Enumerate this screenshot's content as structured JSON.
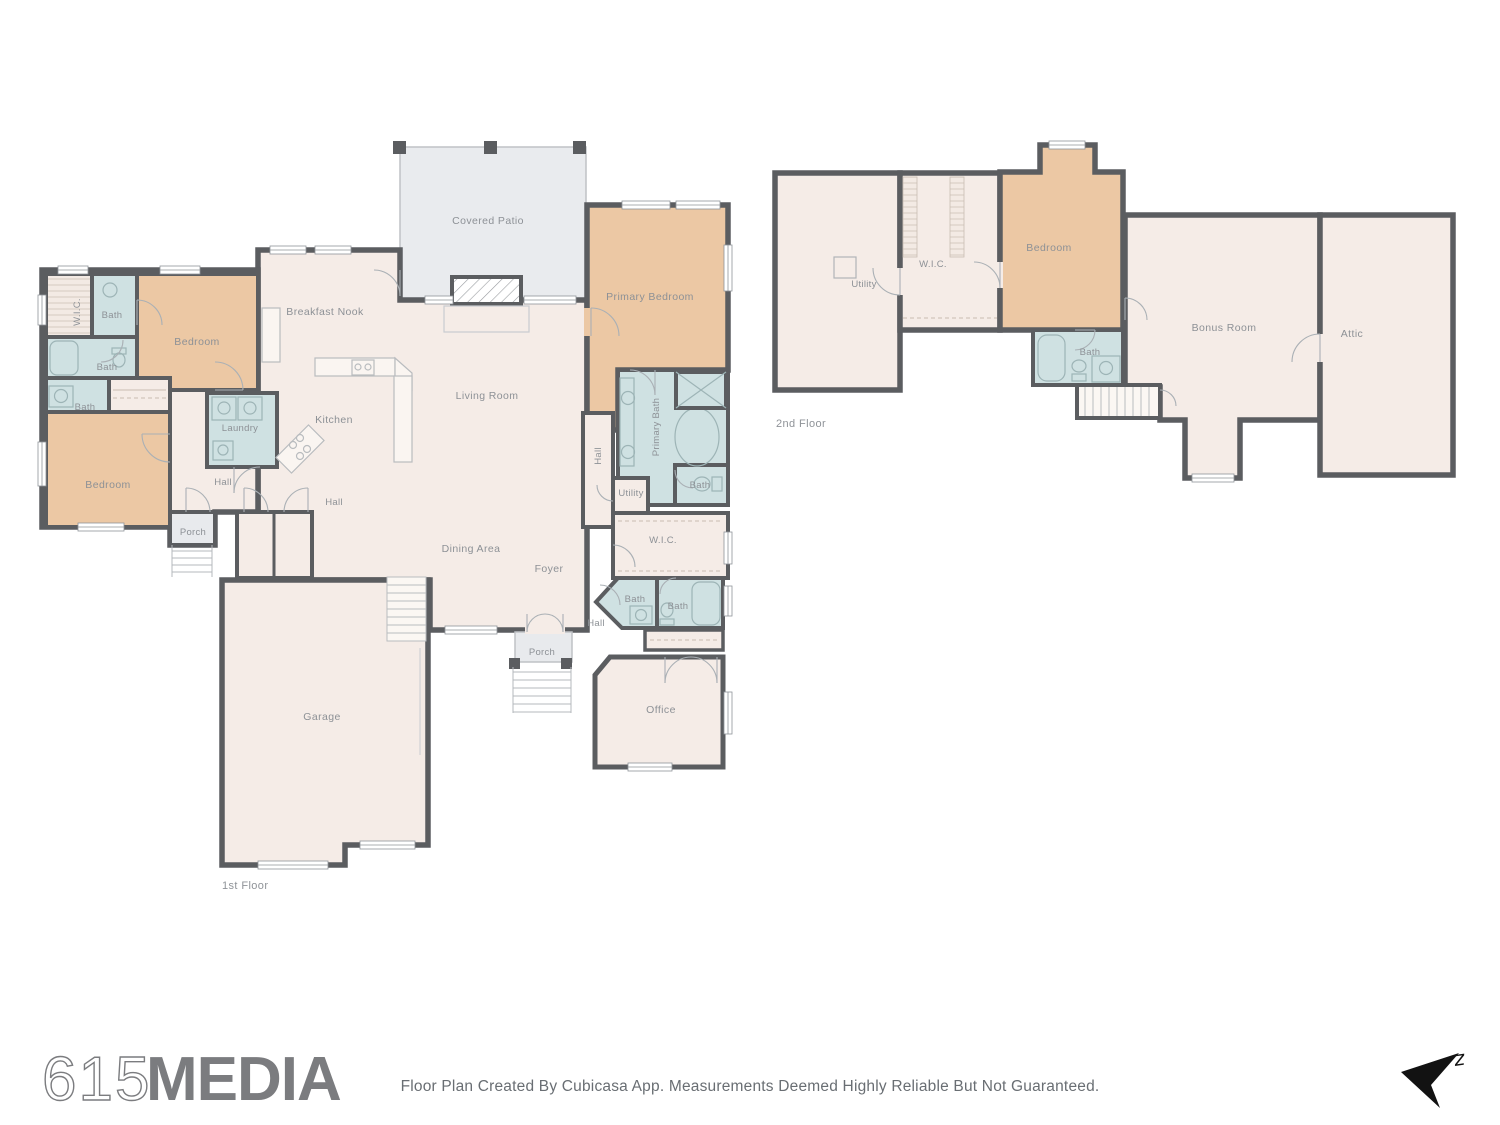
{
  "floors": {
    "floor1": {
      "name": "1st Floor",
      "rooms": {
        "covered_patio": "Covered Patio",
        "primary_bedroom": "Primary Bedroom",
        "breakfast_nook": "Breakfast Nook",
        "bedroom_top": "Bedroom",
        "bedroom_bottom": "Bedroom",
        "wic_left": "W.I.C.",
        "bath_top_left": "Bath",
        "bath_mid_left": "Bath",
        "bath_small_left": "Bath",
        "living_room": "Living Room",
        "kitchen": "Kitchen",
        "laundry": "Laundry",
        "hall_left": "Hall",
        "hall_center": "Hall",
        "hall_right": "Hall",
        "hall_foyer": "Hall",
        "primary_bath": "Primary Bath",
        "utility": "Utility",
        "bath_primary_small": "Bath",
        "porch_left": "Porch",
        "porch_front": "Porch",
        "dining_area": "Dining Area",
        "wic_right": "W.I.C.",
        "foyer": "Foyer",
        "bath_foyer_1": "Bath",
        "bath_foyer_2": "Bath",
        "office": "Office",
        "garage": "Garage"
      }
    },
    "floor2": {
      "name": "2nd Floor",
      "rooms": {
        "utility": "Utility",
        "wic": "W.I.C.",
        "bedroom": "Bedroom",
        "bath": "Bath",
        "bonus_room": "Bonus Room",
        "attic": "Attic"
      }
    }
  },
  "footer": {
    "logo_prefix": "615",
    "logo_suffix": "MEDIA",
    "disclaimer": "Floor Plan Created By Cubicasa App. Measurements Deemed Highly Reliable But Not Guaranteed."
  },
  "compass": {
    "north_label": "z"
  },
  "colors": {
    "floor_cream": "#f5ece7",
    "bedroom_tan": "#ecc8a4",
    "bath_blue": "#cfe1e2",
    "patio_gray": "#e9ebee",
    "wall_gray": "#5b5d60",
    "label_gray": "#8d9196",
    "logo_gray": "#7b7c7f"
  }
}
